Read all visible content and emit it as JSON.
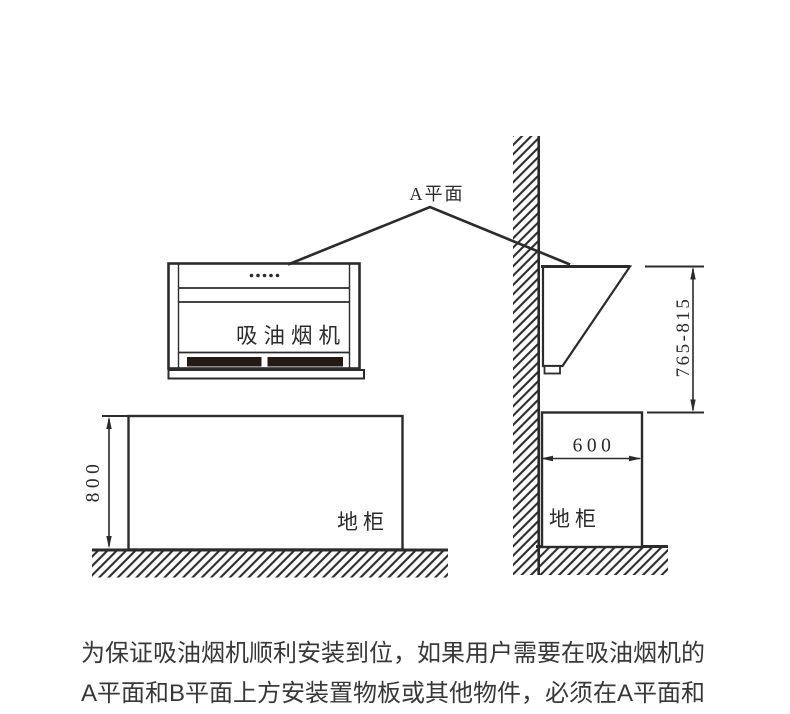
{
  "diagram": {
    "a_plane_label": "A平面",
    "hood_front_label": "吸油烟机",
    "cabinet_left_label": "地柜",
    "cabinet_right_label": "地柜",
    "dim_cabinet_height": "800",
    "dim_cabinet_depth": "600",
    "dim_hood_mount_range": "765-815"
  },
  "note": {
    "line1": "为保证吸油烟机顺利安装到位，如果用户需要在吸油烟机的",
    "line2": "A平面和B平面上方安装置物板或其他物件，必须在A平面和"
  },
  "colors": {
    "line": "#2b2b2b",
    "grille_fill": "#241a14",
    "note_text": "#383838",
    "background": "#ffffff"
  }
}
